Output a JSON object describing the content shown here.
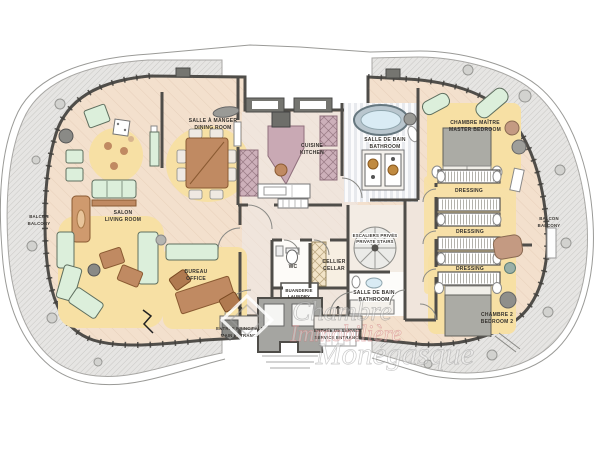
{
  "rooms": {
    "dining": {
      "fr": "SALLE À MANGER",
      "en": "DINING ROOM"
    },
    "kitchen": {
      "fr": "CUISINE",
      "en": "KITCHEN"
    },
    "master_bathroom": {
      "fr": "SALLE DE BAIN",
      "en": "BATHROOM"
    },
    "master_bedroom": {
      "fr": "CHAMBRE MAÎTRE",
      "en": "MASTER BEDROOM"
    },
    "living_room": {
      "fr": "SALON",
      "en": "LIVING ROOM"
    },
    "office": {
      "fr": "BUREAU",
      "en": "OFFICE"
    },
    "wc": {
      "fr": "WC"
    },
    "cellar": {
      "fr": "CELLIER",
      "en": "CELLAR"
    },
    "laundry": {
      "fr": "BUANDERIE",
      "en": "LAUNDRY"
    },
    "private_stairs": {
      "fr": "ESCALIERS PRIVÉS",
      "en": "PRIVATE STAIRS"
    },
    "bathroom_2": {
      "fr": "SALLE DE BAIN",
      "en": "BATHROOM"
    },
    "bedroom_2": {
      "fr": "CHAMBRE 2",
      "en": "BEDROOM 2"
    },
    "dressing_1": {
      "fr": "DRESSING"
    },
    "dressing_2": {
      "fr": "DRESSING"
    },
    "dressing_3": {
      "fr": "DRESSING"
    },
    "balcony_left": {
      "fr": "BALCON",
      "en": "BALCONY"
    },
    "balcony_right": {
      "fr": "BALCON",
      "en": "BALCONY"
    }
  },
  "entrances": {
    "main": {
      "fr": "ENTRÉE PRINCIPALE",
      "en": "MAIN ENTRANCE",
      "arrow": "↑"
    },
    "service": {
      "fr": "ENTRÉE DE SERVICE",
      "en": "SERVICE ENTRANCE",
      "arrow": "↑"
    }
  },
  "watermark": {
    "line1": "Chambre",
    "line2": "Immobilière",
    "line3": "Monégasque"
  },
  "colors": {
    "wall": "#4f4d49",
    "wood_floor": "#f3e0cd",
    "hall_floor": "#f0e5dc",
    "rug_yellow": "#f7e0a4",
    "sofa_mint": "#dcefdb",
    "furniture_brown": "#c08a62",
    "kitchen_mauve": "#c9a9b4",
    "water_blue": "#d9ebf4",
    "balcony_gray": "#e6e5e3",
    "bed_gray": "#ababa5",
    "watermark_red": "#cd7373"
  }
}
